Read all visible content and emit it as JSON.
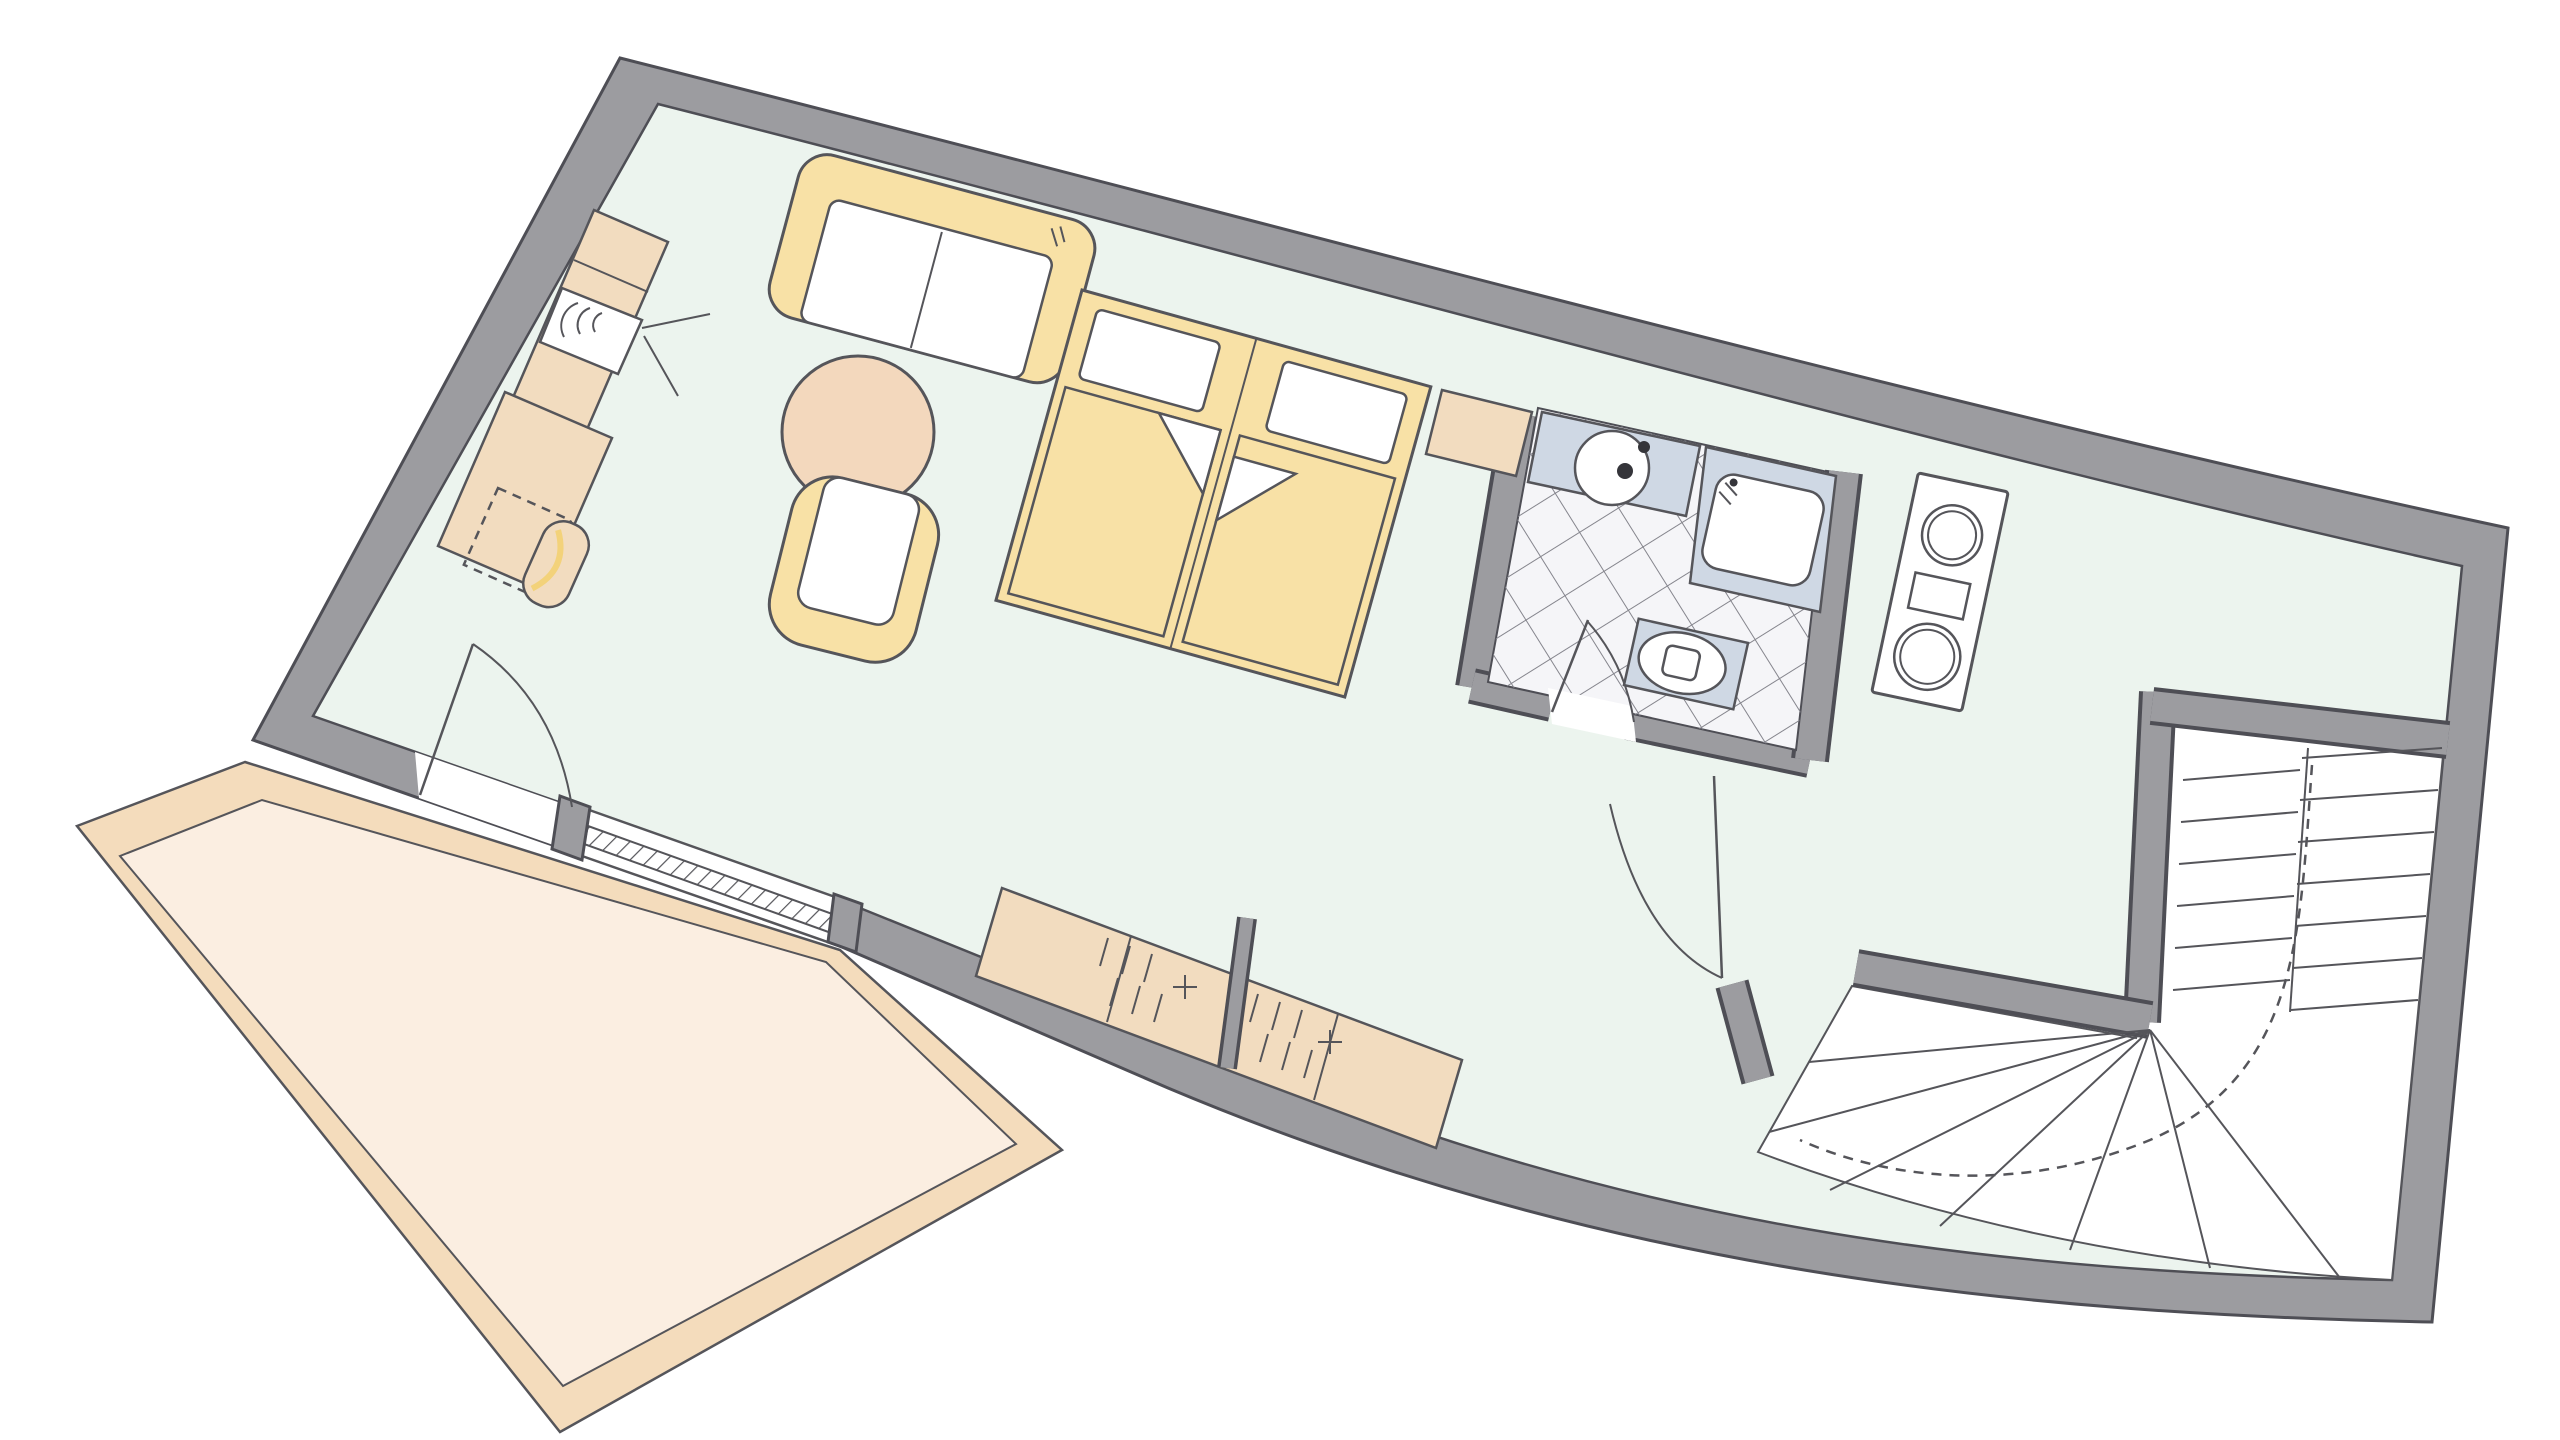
{
  "canvas": {
    "width": 2560,
    "height": 1440,
    "background": "#ffffff"
  },
  "colors": {
    "bg": "#ffffff",
    "wall_fill": "#9c9ca0",
    "wall_outline": "#4e4e55",
    "floor": "#ecf4ee",
    "line": "#55555a",
    "furniture_yellow": "#f8e1a6",
    "furniture_beige": "#f2dcbf",
    "table_peach": "#f3d8bd",
    "terrace_band": "#f4dcbc",
    "terrace_floor": "#fbeee1",
    "fixture_blue": "#cfd8e4",
    "tile_floor": "#f5f5f8",
    "tile_line": "#85858d",
    "white": "#ffffff",
    "chair_accent": "#f3d27a"
  },
  "plan": {
    "kind": "apartment-floor-plan",
    "orientation": "rotated-curved-building",
    "areas": [
      "living-sleeping-room",
      "bathroom",
      "kitchen",
      "hall",
      "winder-staircase",
      "terrace"
    ],
    "furniture": [
      "sideboard",
      "tv",
      "desk",
      "desk-chair",
      "sofa",
      "round-table",
      "armchair",
      "double-bed",
      "nightstand",
      "wardrobe"
    ],
    "fixtures": [
      "washbasin",
      "shower",
      "toilet",
      "kitchen-unit",
      "sliding-terrace-door",
      "terrace-swing-door",
      "hall-door",
      "bathroom-door"
    ]
  }
}
